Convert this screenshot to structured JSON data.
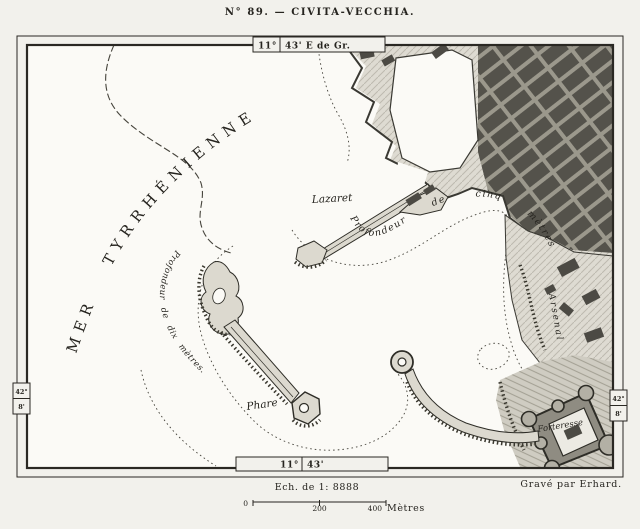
{
  "title": "N° 89. — CIVITA-VECCHIA.",
  "frame": {
    "top_deg": "11°",
    "top_min": "43' E de Gr.",
    "bottom_deg": "11°",
    "bottom_min": "43'",
    "left_lat_deg": "42°",
    "left_lat_min": "8'",
    "right_lat_deg": "42°",
    "right_lat_min": "8'"
  },
  "sea": {
    "name": "MER TYRRHÉNIENNE"
  },
  "labels": {
    "lazaret": "Lazaret",
    "depth_five": "Profondeur de cinq mètres",
    "depth_ten": "Profondeur de dix mètres.",
    "phare": "Phare",
    "forteresse": "Forteresse",
    "arsenal": "Arsenal"
  },
  "scale": {
    "label": "Ech. de 1: 8888",
    "tick_start": "0",
    "tick_mid": "200",
    "tick_end": "400",
    "unit": "Mètres"
  },
  "credit": "Gravé par Erhard.",
  "colors": {
    "ink": "#26241f",
    "paper": "#f2f1ec",
    "sea": "#fbfaf6",
    "land": "#dedbd2",
    "city_block": "#54524b"
  }
}
